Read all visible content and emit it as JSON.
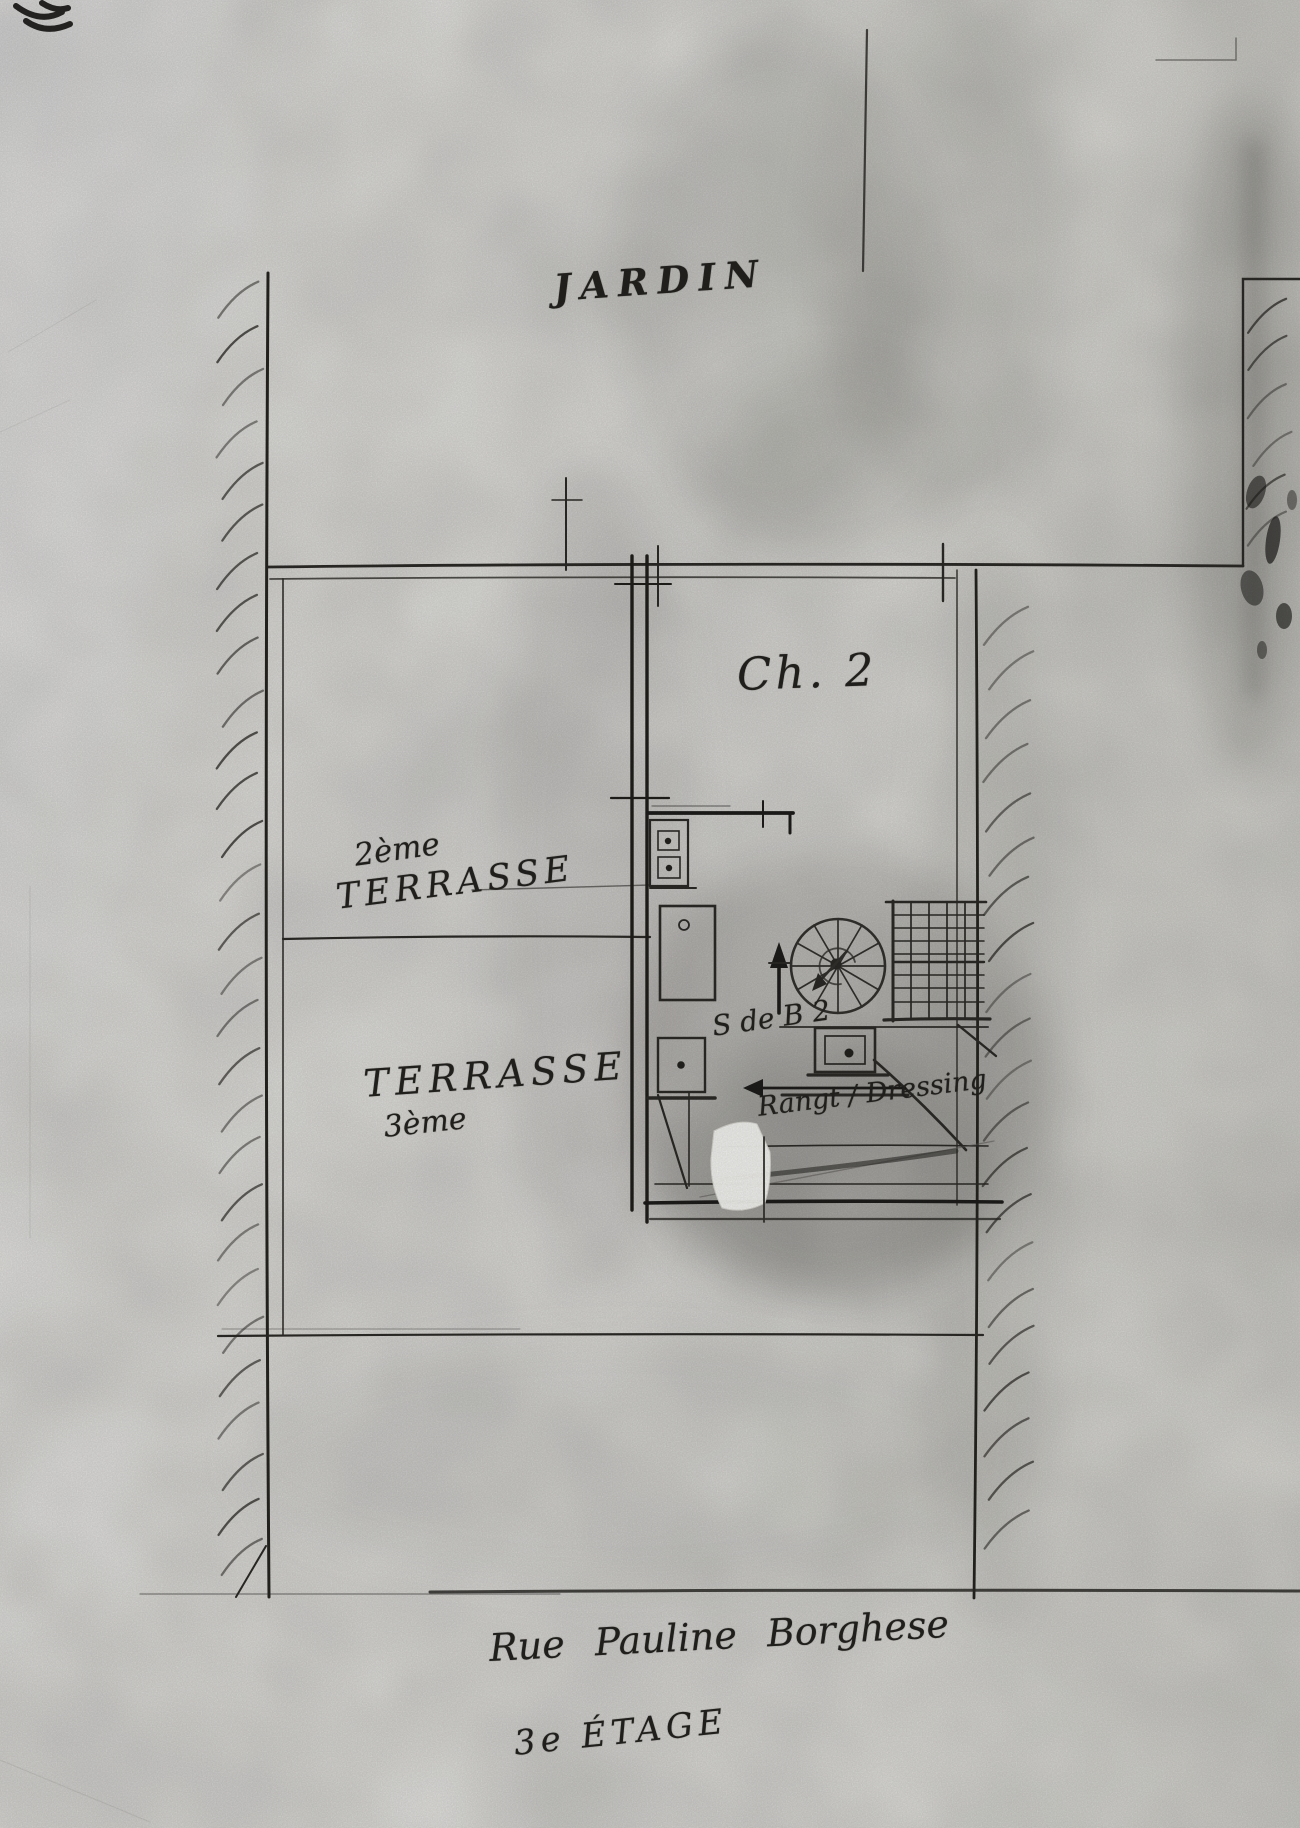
{
  "labels": {
    "garden": "JARDIN",
    "bedroom": "Ch. 2",
    "terrace2": {
      "line1": "2ème",
      "line2": "TERRASSE"
    },
    "terrace3": {
      "line1": "TERRASSE",
      "line2": "3ème"
    },
    "bathroom": "S de B 2",
    "storage": "Rangt / Dressing",
    "street": "Rue Pauline Borghese",
    "floor": "3e ÉTAGE"
  },
  "colors": {
    "ink": "#23221f",
    "bold_wall": "#1d1c1a",
    "pencil": "#5c5a55",
    "paper": "#f3f2ee",
    "correction_patch": "#fafaf7"
  },
  "plan_features": [
    "left-boundary-wall-hatched",
    "right-boundary-wall-hatched",
    "top-right-boundary-wall-hatched",
    "garden-boundary-line",
    "terrace-divider-line",
    "terrace-bottom-line",
    "street-boundary-line",
    "central-service-wall",
    "kitchen-fixtures",
    "bathroom-walls",
    "toilet-fixture",
    "spiral-staircase",
    "trellis-grid",
    "up-stairs-arrow",
    "left-direction-arrow",
    "correction-fluid-patch",
    "ink-scribble-top-left",
    "ink-blotches-top-right"
  ]
}
